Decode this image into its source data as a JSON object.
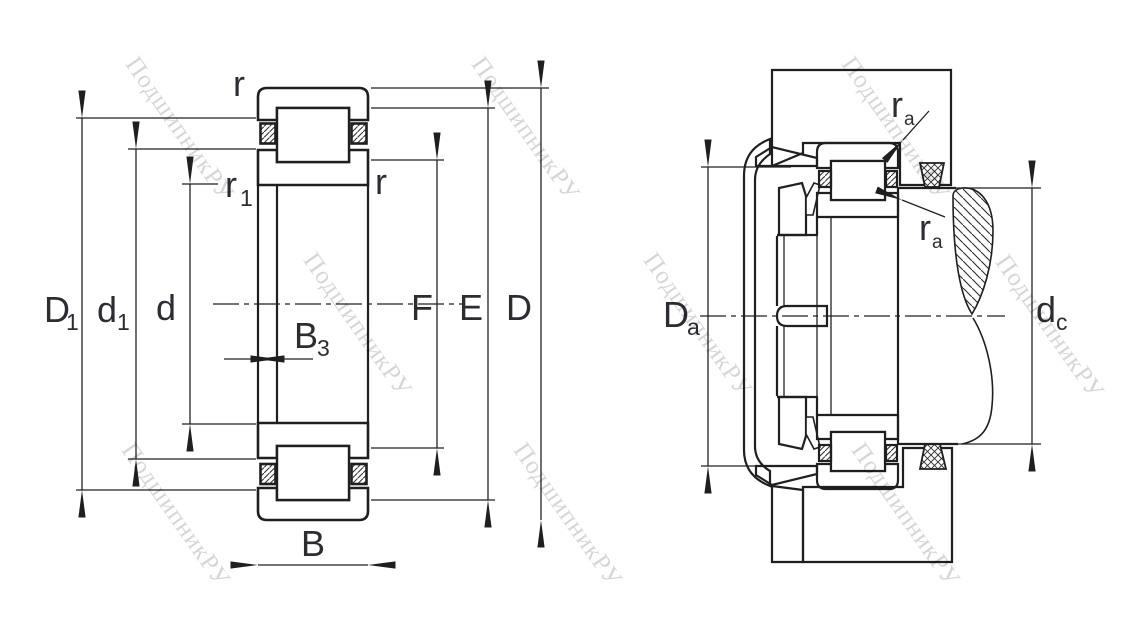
{
  "watermark": {
    "text": "ПодшипникРУ",
    "color": "#bcbcbc"
  },
  "colors": {
    "line": "#1f1f1f",
    "label": "#2c2d33",
    "background": "#ffffff"
  },
  "figures": {
    "left": {
      "name": "bearing-cross-section-dimensions",
      "labels": {
        "r_top": {
          "main": "r"
        },
        "r_right": {
          "main": "r"
        },
        "r1": {
          "main": "r",
          "sub": "1"
        },
        "D1": {
          "main": "D",
          "sub": "1"
        },
        "d1": {
          "main": "d",
          "sub": "1"
        },
        "d": {
          "main": "d"
        },
        "B3": {
          "main": "B",
          "sub": "3"
        },
        "B": {
          "main": "B"
        },
        "F": {
          "main": "F"
        },
        "E": {
          "main": "E"
        },
        "D": {
          "main": "D"
        }
      }
    },
    "right": {
      "name": "bearing-mounted-abutment-dimensions",
      "labels": {
        "ra_top": {
          "main": "r",
          "sub": "a"
        },
        "ra_bottom": {
          "main": "r",
          "sub": "a"
        },
        "Da": {
          "main": "D",
          "sub": "a"
        },
        "dc": {
          "main": "d",
          "sub": "c"
        }
      }
    }
  }
}
